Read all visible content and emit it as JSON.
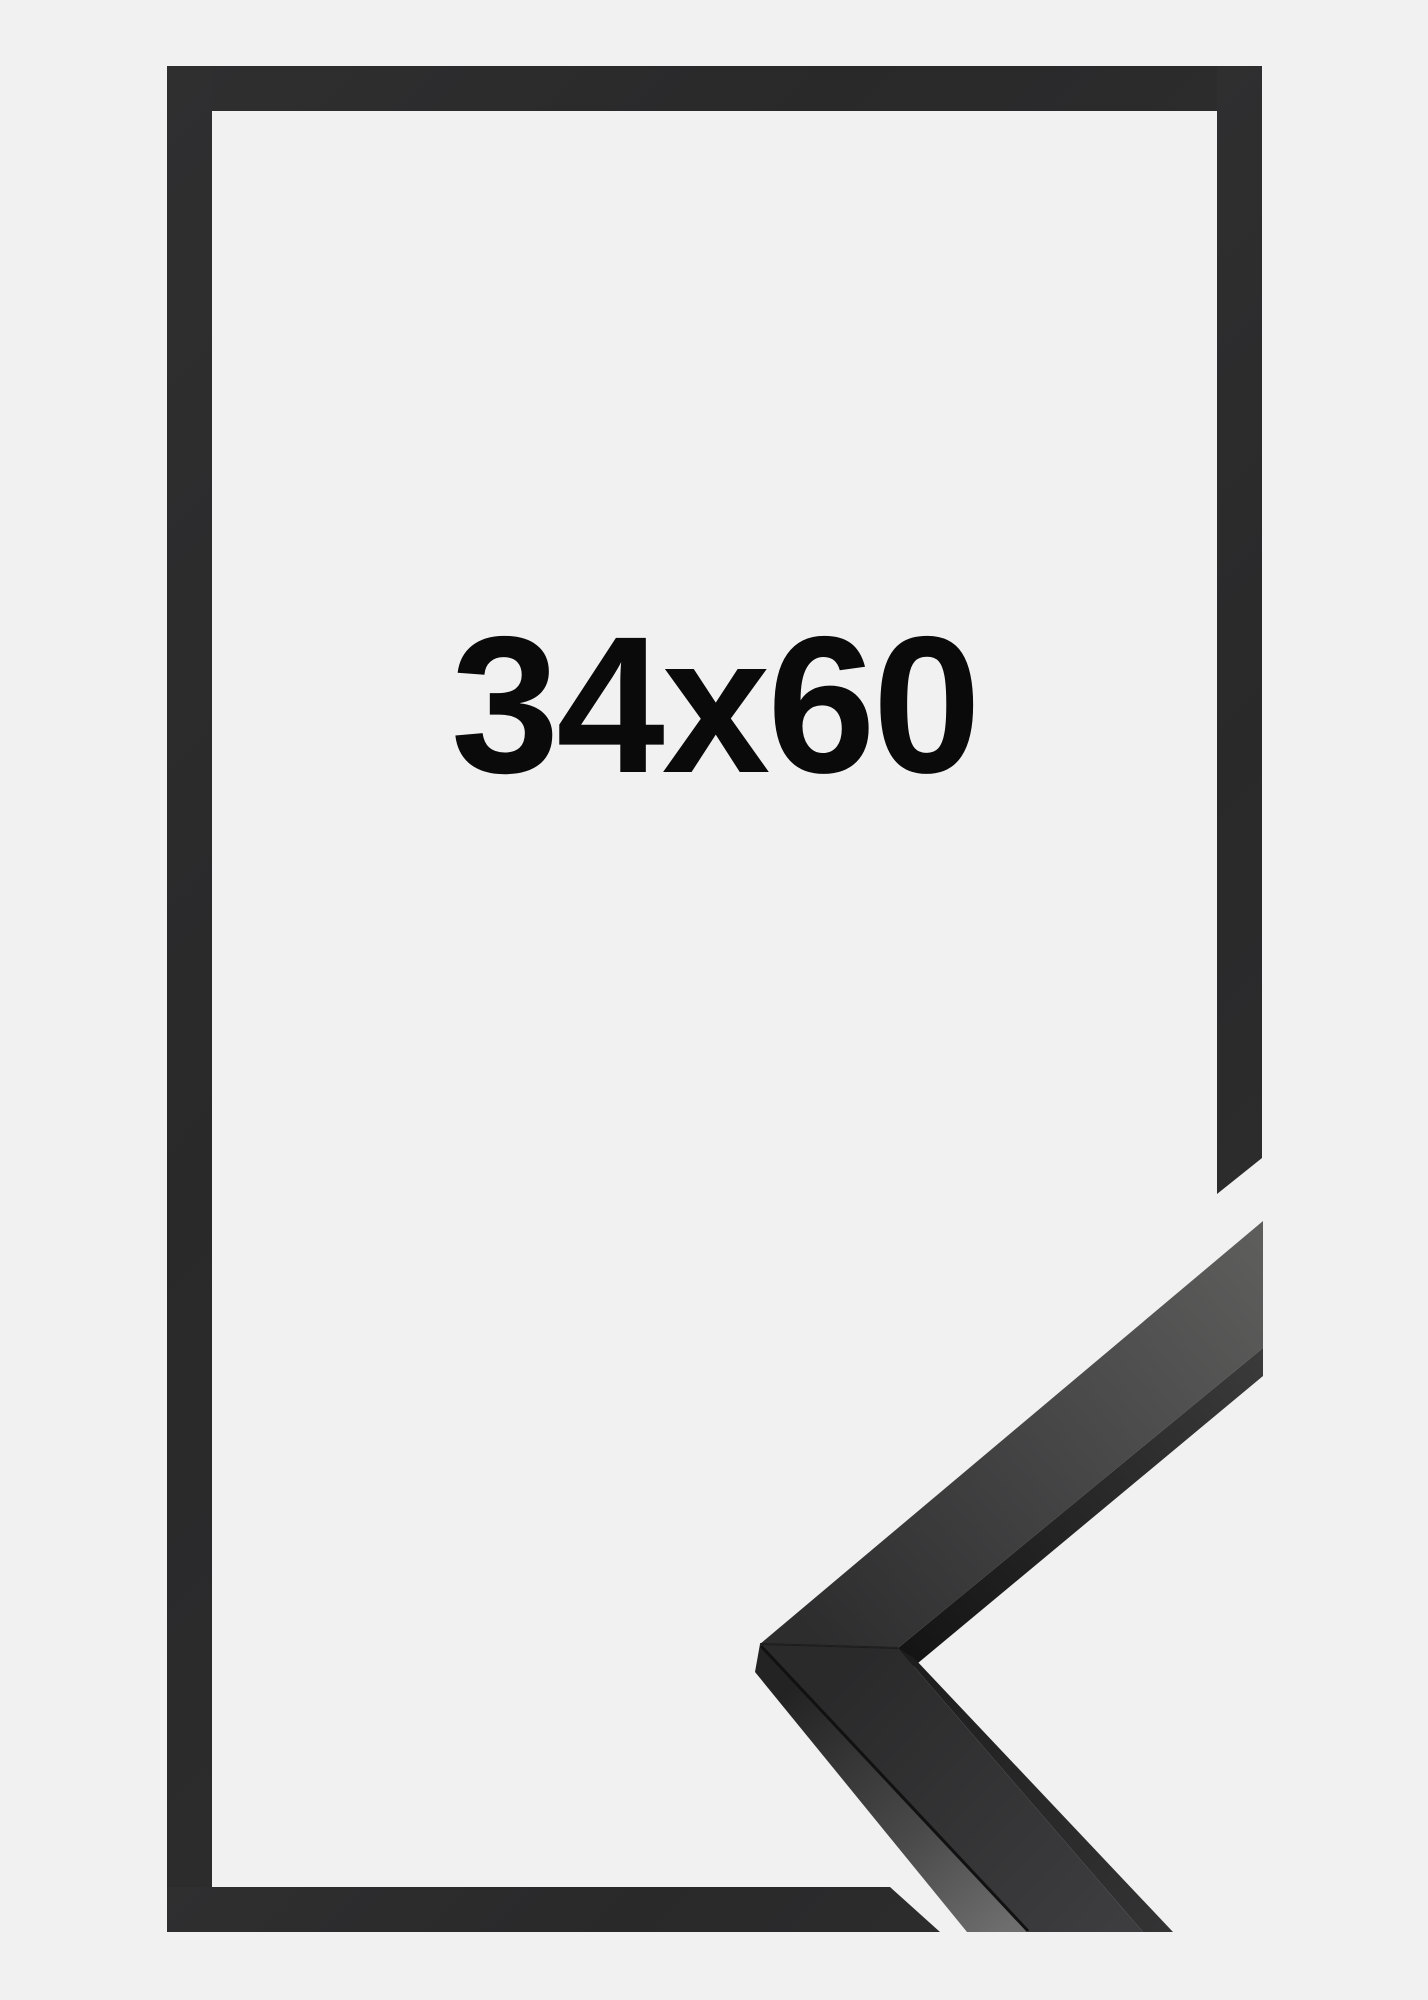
{
  "product": {
    "size_label": "34x60",
    "colors": {
      "background": "#f1f1f2",
      "frame_outline": "#2b2b2c",
      "label_text": "#0a0a0a",
      "moulding_top_face_near": "#2e2e2e",
      "moulding_top_face_far": "#5d5d5d",
      "moulding_side_face_light": "#6a6a6a",
      "moulding_edge_shadow": "#141414"
    }
  }
}
